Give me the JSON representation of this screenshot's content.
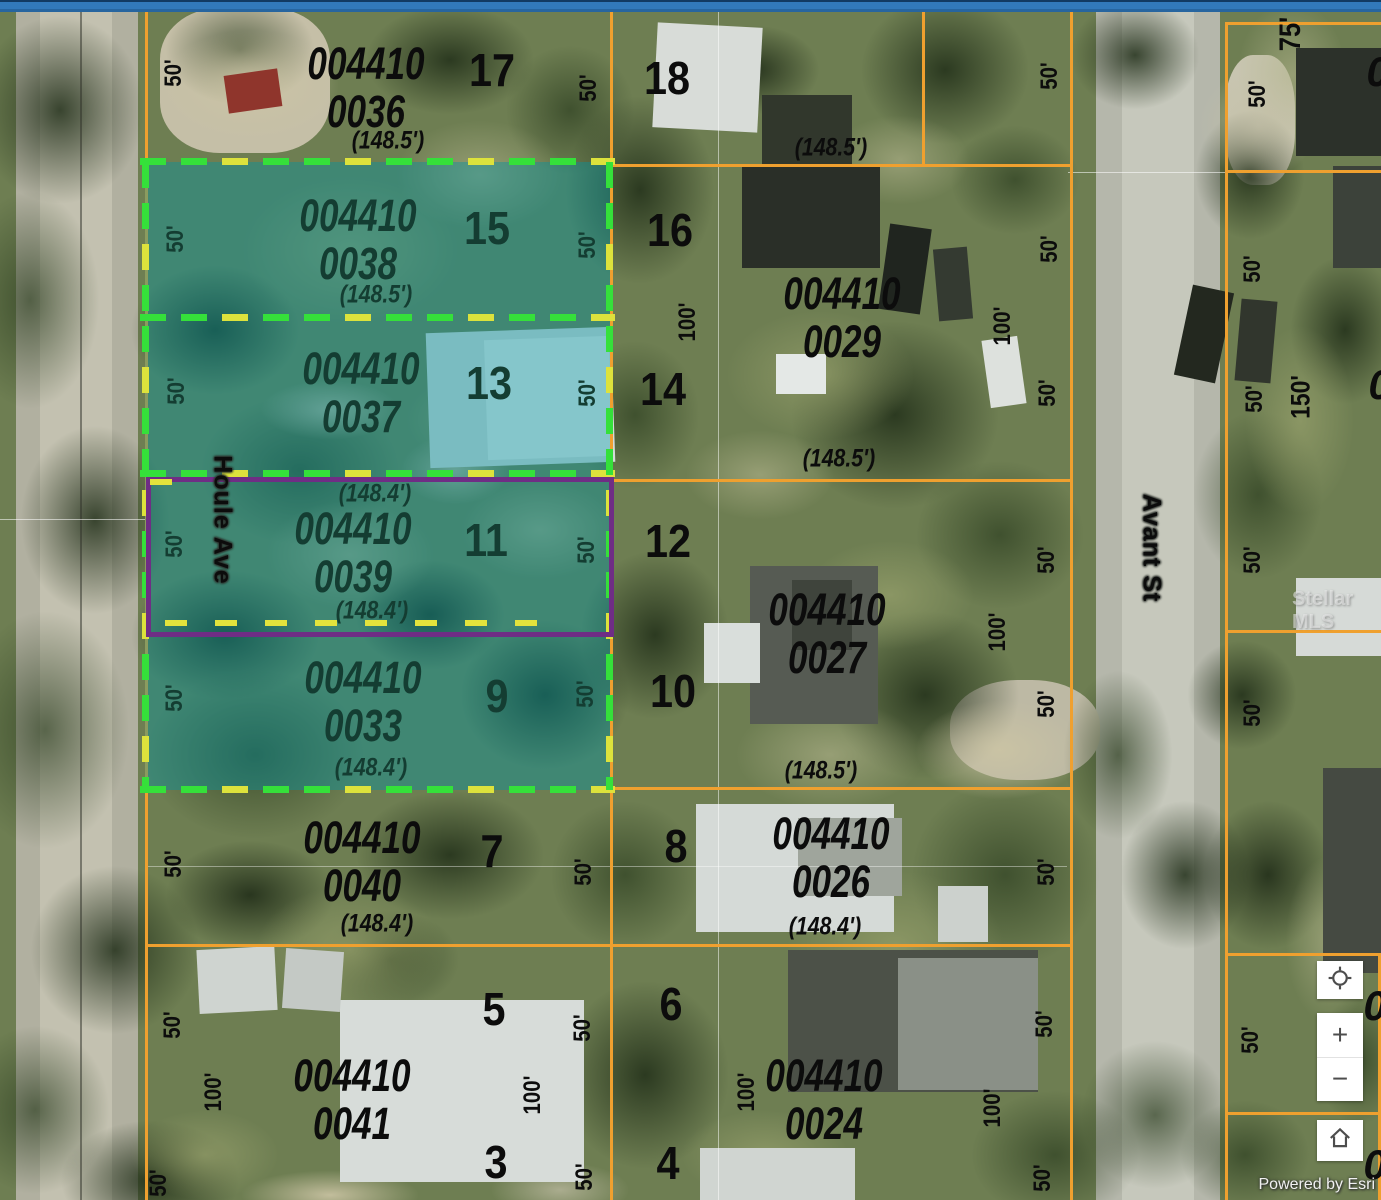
{
  "attribution": {
    "text": "Powered by Esri"
  },
  "controls": {
    "zoom_in": "+",
    "zoom_out": "−"
  },
  "map": {
    "watermark": "Stellar MLS",
    "highlighted_parcels": [
      "004410 0038",
      "004410 0037",
      "004410 0039",
      "004410 0033"
    ],
    "selected_parcel": "004410 0039",
    "colors": {
      "parcel_line": "#efa02f",
      "highlight_fill": "rgba(0,148,162,0.42)",
      "dash_green": "#35e03a",
      "dash_yellow": "#dde23c",
      "selected_outline": "#6f2d85",
      "top_bar": "#3279ba"
    },
    "streets": [
      {
        "name": "Houle Ave",
        "x": 222,
        "y": 520
      },
      {
        "name": "Avant St",
        "x": 1151,
        "y": 548
      }
    ],
    "labels": {
      "parcel_ids": [
        {
          "text": "004410\n0036",
          "x": 366,
          "y": 88,
          "tone": "black"
        },
        {
          "text": "004410\n0038",
          "x": 358,
          "y": 240,
          "tone": "green"
        },
        {
          "text": "004410\n0037",
          "x": 361,
          "y": 393,
          "tone": "green"
        },
        {
          "text": "004410\n0039",
          "x": 353,
          "y": 553,
          "tone": "green"
        },
        {
          "text": "004410\n0033",
          "x": 363,
          "y": 702,
          "tone": "green"
        },
        {
          "text": "004410\n0040",
          "x": 362,
          "y": 862,
          "tone": "black"
        },
        {
          "text": "004410\n0041",
          "x": 352,
          "y": 1100,
          "tone": "black"
        },
        {
          "text": "004410\n0029",
          "x": 842,
          "y": 318,
          "tone": "black"
        },
        {
          "text": "004410\n0027",
          "x": 827,
          "y": 634,
          "tone": "black"
        },
        {
          "text": "004410\n0026",
          "x": 831,
          "y": 858,
          "tone": "black"
        },
        {
          "text": "004410\n0024",
          "x": 824,
          "y": 1100,
          "tone": "black"
        }
      ],
      "frontages": [
        {
          "text": "(148.5')",
          "x": 388,
          "y": 141,
          "tone": "black"
        },
        {
          "text": "(148.5')",
          "x": 831,
          "y": 148,
          "tone": "black"
        },
        {
          "text": "(148.5')",
          "x": 376,
          "y": 295,
          "tone": "green"
        },
        {
          "text": "(148.4')",
          "x": 375,
          "y": 494,
          "tone": "green"
        },
        {
          "text": "(148.4')",
          "x": 372,
          "y": 611,
          "tone": "green"
        },
        {
          "text": "(148.4')",
          "x": 371,
          "y": 768,
          "tone": "green"
        },
        {
          "text": "(148.5')",
          "x": 839,
          "y": 459,
          "tone": "black"
        },
        {
          "text": "(148.5')",
          "x": 821,
          "y": 771,
          "tone": "black"
        },
        {
          "text": "(148.4')",
          "x": 377,
          "y": 924,
          "tone": "black"
        },
        {
          "text": "(148.4')",
          "x": 825,
          "y": 927,
          "tone": "black"
        }
      ],
      "lots": [
        {
          "text": "17",
          "x": 492,
          "y": 70,
          "tone": "black"
        },
        {
          "text": "18",
          "x": 667,
          "y": 78,
          "tone": "black"
        },
        {
          "text": "15",
          "x": 487,
          "y": 228,
          "tone": "green"
        },
        {
          "text": "16",
          "x": 670,
          "y": 230,
          "tone": "black"
        },
        {
          "text": "13",
          "x": 489,
          "y": 383,
          "tone": "green"
        },
        {
          "text": "14",
          "x": 663,
          "y": 389,
          "tone": "black"
        },
        {
          "text": "11",
          "x": 486,
          "y": 540,
          "tone": "green"
        },
        {
          "text": "12",
          "x": 668,
          "y": 541,
          "tone": "black"
        },
        {
          "text": "9",
          "x": 497,
          "y": 696,
          "tone": "green"
        },
        {
          "text": "10",
          "x": 673,
          "y": 691,
          "tone": "black"
        },
        {
          "text": "7",
          "x": 492,
          "y": 851,
          "tone": "black"
        },
        {
          "text": "8",
          "x": 676,
          "y": 846,
          "tone": "black"
        },
        {
          "text": "5",
          "x": 494,
          "y": 1009,
          "tone": "black"
        },
        {
          "text": "6",
          "x": 671,
          "y": 1004,
          "tone": "black"
        },
        {
          "text": "3",
          "x": 496,
          "y": 1162,
          "tone": "black"
        },
        {
          "text": "4",
          "x": 668,
          "y": 1163,
          "tone": "black"
        }
      ],
      "dims": [
        {
          "text": "50'",
          "x": 174,
          "y": 73,
          "tone": "black"
        },
        {
          "text": "50'",
          "x": 176,
          "y": 239,
          "tone": "green"
        },
        {
          "text": "50'",
          "x": 177,
          "y": 391,
          "tone": "green"
        },
        {
          "text": "50'",
          "x": 175,
          "y": 544,
          "tone": "green"
        },
        {
          "text": "50'",
          "x": 175,
          "y": 698,
          "tone": "green"
        },
        {
          "text": "50'",
          "x": 174,
          "y": 864,
          "tone": "black"
        },
        {
          "text": "50'",
          "x": 173,
          "y": 1025,
          "tone": "black"
        },
        {
          "text": "100'",
          "x": 214,
          "y": 1092,
          "tone": "black"
        },
        {
          "text": "50'",
          "x": 159,
          "y": 1183,
          "tone": "black"
        },
        {
          "text": "50'",
          "x": 589,
          "y": 88,
          "tone": "black"
        },
        {
          "text": "50'",
          "x": 588,
          "y": 245,
          "tone": "green"
        },
        {
          "text": "50'",
          "x": 588,
          "y": 393,
          "tone": "green"
        },
        {
          "text": "50'",
          "x": 587,
          "y": 550,
          "tone": "green"
        },
        {
          "text": "50'",
          "x": 586,
          "y": 694,
          "tone": "green"
        },
        {
          "text": "50'",
          "x": 584,
          "y": 872,
          "tone": "black"
        },
        {
          "text": "100'",
          "x": 533,
          "y": 1095,
          "tone": "black"
        },
        {
          "text": "50'",
          "x": 583,
          "y": 1028,
          "tone": "black"
        },
        {
          "text": "50'",
          "x": 585,
          "y": 1177,
          "tone": "black"
        },
        {
          "text": "100'",
          "x": 688,
          "y": 322,
          "tone": "black"
        },
        {
          "text": "100'",
          "x": 747,
          "y": 1092,
          "tone": "black"
        },
        {
          "text": "50'",
          "x": 1050,
          "y": 76,
          "tone": "black"
        },
        {
          "text": "50'",
          "x": 1050,
          "y": 249,
          "tone": "black"
        },
        {
          "text": "100'",
          "x": 1003,
          "y": 326,
          "tone": "black"
        },
        {
          "text": "50'",
          "x": 1048,
          "y": 393,
          "tone": "black"
        },
        {
          "text": "50'",
          "x": 1047,
          "y": 560,
          "tone": "black"
        },
        {
          "text": "100'",
          "x": 998,
          "y": 632,
          "tone": "black"
        },
        {
          "text": "50'",
          "x": 1047,
          "y": 704,
          "tone": "black"
        },
        {
          "text": "50'",
          "x": 1047,
          "y": 872,
          "tone": "black"
        },
        {
          "text": "50'",
          "x": 1045,
          "y": 1024,
          "tone": "black"
        },
        {
          "text": "100'",
          "x": 993,
          "y": 1108,
          "tone": "black"
        },
        {
          "text": "50'",
          "x": 1043,
          "y": 1178,
          "tone": "black"
        },
        {
          "text": "75'",
          "x": 1291,
          "y": 34,
          "tone": "black",
          "size": 30
        },
        {
          "text": "50'",
          "x": 1258,
          "y": 94,
          "tone": "black"
        },
        {
          "text": "50'",
          "x": 1253,
          "y": 269,
          "tone": "black"
        },
        {
          "text": "50'",
          "x": 1255,
          "y": 399,
          "tone": "black"
        },
        {
          "text": "150'",
          "x": 1301,
          "y": 397,
          "tone": "black",
          "size": 27
        },
        {
          "text": "50'",
          "x": 1253,
          "y": 560,
          "tone": "black"
        },
        {
          "text": "50'",
          "x": 1253,
          "y": 713,
          "tone": "black"
        },
        {
          "text": "50'",
          "x": 1251,
          "y": 1040,
          "tone": "black"
        }
      ],
      "partials": [
        {
          "text": "0",
          "x": 1378,
          "y": 72
        },
        {
          "text": "0",
          "x": 1380,
          "y": 385
        },
        {
          "text": "0",
          "x": 1375,
          "y": 1006
        },
        {
          "text": "0",
          "x": 1375,
          "y": 1165
        }
      ]
    }
  }
}
